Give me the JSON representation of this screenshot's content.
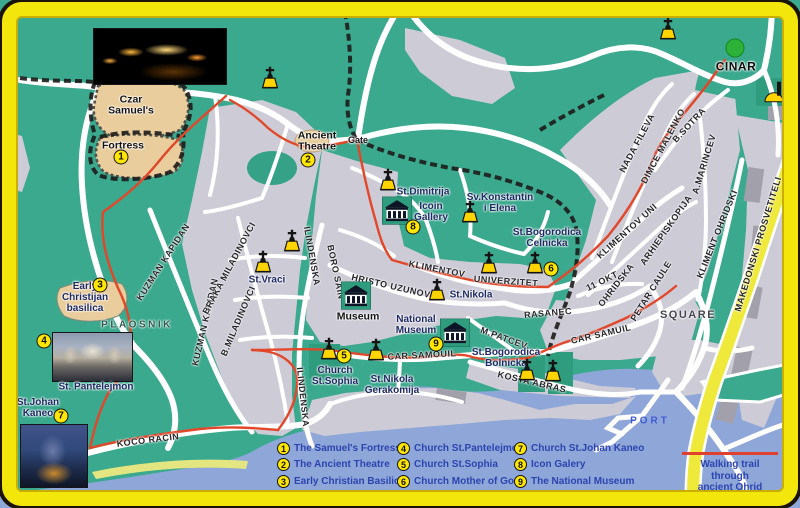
{
  "colors": {
    "land_green": "#3BA98E",
    "building_gray": "#CDCBD6",
    "road_white": "#FFFFFF",
    "water_blue": "#8FA6D9",
    "trail_red": "#E2472A",
    "frame_yellow": "#F2E60A",
    "yellow_road": "#EFE93C",
    "marker_yellow": "#FFE604",
    "museum_green": "#2F9C7D",
    "fortress_tan": "#E9CD9C"
  },
  "legend": {
    "items": [
      {
        "n": "1",
        "label": "The Samuel's Fortress"
      },
      {
        "n": "2",
        "label": "The Ancient Theatre"
      },
      {
        "n": "3",
        "label": "Early Christian Basilica"
      },
      {
        "n": "4",
        "label": "Church St.Pantelejmon"
      },
      {
        "n": "5",
        "label": "Church St.Sophia"
      },
      {
        "n": "6",
        "label": "Church Mother of God"
      },
      {
        "n": "7",
        "label": "Church St.Johan Kaneo"
      },
      {
        "n": "8",
        "label": "Icon Galery"
      },
      {
        "n": "9",
        "label": "The National Museum"
      }
    ],
    "note_line1": "Walking trail through",
    "note_line2": "ancient Ohrid"
  },
  "map": {
    "streets": [
      {
        "t": "KUZMAN KAPIDAN",
        "x": 163,
        "y": 262,
        "r": -57
      },
      {
        "t": "KUZMAN KAPIDAN",
        "x": 205,
        "y": 322,
        "r": -77
      },
      {
        "t": "BRAKA MILADINOVCI",
        "x": 229,
        "y": 268,
        "r": -62
      },
      {
        "t": "B.MILADINOVCI",
        "x": 238,
        "y": 321,
        "r": -67
      },
      {
        "t": "ILINDENSKA",
        "x": 312,
        "y": 256,
        "r": 80
      },
      {
        "t": "ILINDENSKA",
        "x": 303,
        "y": 397,
        "r": 84
      },
      {
        "t": "BORO SAIN",
        "x": 336,
        "y": 272,
        "r": 78
      },
      {
        "t": "HRISTO UZUNOV",
        "x": 391,
        "y": 286,
        "r": 13
      },
      {
        "t": "KLIMENTOV",
        "x": 437,
        "y": 269,
        "r": 11
      },
      {
        "t": "UNIVERZITET",
        "x": 506,
        "y": 281,
        "r": 4
      },
      {
        "t": "KLIMENTOV UNI",
        "x": 627,
        "y": 231,
        "r": -42
      },
      {
        "t": "NADA FILEVA",
        "x": 637,
        "y": 143,
        "r": -62
      },
      {
        "t": "DIMCE MALENKO",
        "x": 663,
        "y": 146,
        "r": -62
      },
      {
        "t": "B.SOTRA",
        "x": 689,
        "y": 125,
        "r": -47
      },
      {
        "t": "A.MARINCEV",
        "x": 704,
        "y": 164,
        "r": -73
      },
      {
        "t": "KLIMENT OHRIDSKI",
        "x": 717,
        "y": 234,
        "r": -68
      },
      {
        "t": "MAKEDONSKI PROSVETITELI",
        "x": 758,
        "y": 244,
        "r": -73
      },
      {
        "t": "11 OKT",
        "x": 602,
        "y": 281,
        "r": -26
      },
      {
        "t": "OHRIDSKA",
        "x": 616,
        "y": 285,
        "r": -52
      },
      {
        "t": "ARHIEPISKOPIJA",
        "x": 666,
        "y": 230,
        "r": -55
      },
      {
        "t": "PETAR CAULE",
        "x": 651,
        "y": 291,
        "r": -58
      },
      {
        "t": "RASANEC",
        "x": 548,
        "y": 313,
        "r": -5
      },
      {
        "t": "M.PATCEV",
        "x": 504,
        "y": 338,
        "r": 20
      },
      {
        "t": "CAR SAMUIL",
        "x": 601,
        "y": 334,
        "r": -13
      },
      {
        "t": "CAR SAMOUIL",
        "x": 422,
        "y": 355,
        "r": -3
      },
      {
        "t": "KOSTA ABRAS",
        "x": 532,
        "y": 382,
        "r": 13
      },
      {
        "t": "KOCO RACIN",
        "x": 148,
        "y": 440,
        "r": -7
      },
      {
        "t": "PLAOSNIK",
        "x": 137,
        "y": 325,
        "r": 0,
        "k": "plaosnik"
      }
    ],
    "places": [
      {
        "t": "Czar\nSamuel's",
        "x": 131,
        "y": 106,
        "k": "dark"
      },
      {
        "t": "Fortress",
        "x": 123,
        "y": 146,
        "k": "dark"
      },
      {
        "t": "Ancient\nTheatre",
        "x": 317,
        "y": 142,
        "k": "dark"
      },
      {
        "t": "Gate",
        "x": 358,
        "y": 141,
        "k": "gate"
      },
      {
        "t": "St.Dimitrija",
        "x": 423,
        "y": 193
      },
      {
        "t": "Icoin\nGallery",
        "x": 431,
        "y": 213
      },
      {
        "t": "Sv.Konstantin\ni Elena",
        "x": 500,
        "y": 204
      },
      {
        "t": "St.Bogorodica\nCelnicka",
        "x": 547,
        "y": 239
      },
      {
        "t": "St.Nikola",
        "x": 471,
        "y": 296
      },
      {
        "t": "St.Vraci",
        "x": 267,
        "y": 281
      },
      {
        "t": "Museum",
        "x": 358,
        "y": 317,
        "k": "dark"
      },
      {
        "t": "National\nMuseum",
        "x": 416,
        "y": 326
      },
      {
        "t": "Church\nSt.Sophia",
        "x": 335,
        "y": 377
      },
      {
        "t": "St.Nikola\nGerakomija",
        "x": 392,
        "y": 386
      },
      {
        "t": "St.Bogorodica\nBolnicka",
        "x": 506,
        "y": 359
      },
      {
        "t": "Early\nChristijan\nbasilica",
        "x": 85,
        "y": 298
      },
      {
        "t": "St. Pantelejmon",
        "x": 96,
        "y": 388
      },
      {
        "t": "St.Johan\nKaneo",
        "x": 38,
        "y": 409
      },
      {
        "t": "PORT",
        "x": 650,
        "y": 422,
        "k": "port"
      },
      {
        "t": "CINAR",
        "x": 736,
        "y": 67,
        "k": "cinar"
      },
      {
        "t": "SQUARE",
        "x": 688,
        "y": 316,
        "k": "square"
      }
    ],
    "pois": [
      {
        "n": "1",
        "x": 121,
        "y": 157
      },
      {
        "n": "2",
        "x": 308,
        "y": 160
      },
      {
        "n": "3",
        "x": 100,
        "y": 285
      },
      {
        "n": "4",
        "x": 44,
        "y": 341
      },
      {
        "n": "5",
        "x": 344,
        "y": 356
      },
      {
        "n": "6",
        "x": 551,
        "y": 269
      },
      {
        "n": "7",
        "x": 61,
        "y": 416
      },
      {
        "n": "8",
        "x": 413,
        "y": 227
      },
      {
        "n": "9",
        "x": 436,
        "y": 344
      }
    ],
    "icons": [
      {
        "type": "church",
        "x": 270,
        "y": 80
      },
      {
        "type": "church",
        "x": 668,
        "y": 31
      },
      {
        "type": "church",
        "x": 388,
        "y": 182
      },
      {
        "type": "church",
        "x": 470,
        "y": 214
      },
      {
        "type": "church",
        "x": 292,
        "y": 243
      },
      {
        "type": "church",
        "x": 263,
        "y": 264
      },
      {
        "type": "church",
        "x": 489,
        "y": 265
      },
      {
        "type": "church",
        "x": 535,
        "y": 265
      },
      {
        "type": "church",
        "x": 437,
        "y": 292
      },
      {
        "type": "church",
        "x": 329,
        "y": 351
      },
      {
        "type": "church",
        "x": 376,
        "y": 352
      },
      {
        "type": "church",
        "x": 527,
        "y": 372
      },
      {
        "type": "church",
        "x": 553,
        "y": 373
      },
      {
        "type": "museum",
        "x": 356,
        "y": 297
      },
      {
        "type": "museum",
        "x": 397,
        "y": 212
      },
      {
        "type": "museum",
        "x": 455,
        "y": 334
      },
      {
        "type": "tree",
        "x": 735,
        "y": 49
      },
      {
        "type": "monument",
        "x": 774,
        "y": 92
      }
    ],
    "photos": [
      {
        "id": "fortress-photo",
        "x": 93,
        "y": 28,
        "w": 134,
        "h": 57
      },
      {
        "id": "pantelejmon-photo",
        "x": 52,
        "y": 332,
        "w": 81,
        "h": 50
      },
      {
        "id": "kaneo-photo",
        "x": 20,
        "y": 424,
        "w": 68,
        "h": 64
      }
    ]
  }
}
